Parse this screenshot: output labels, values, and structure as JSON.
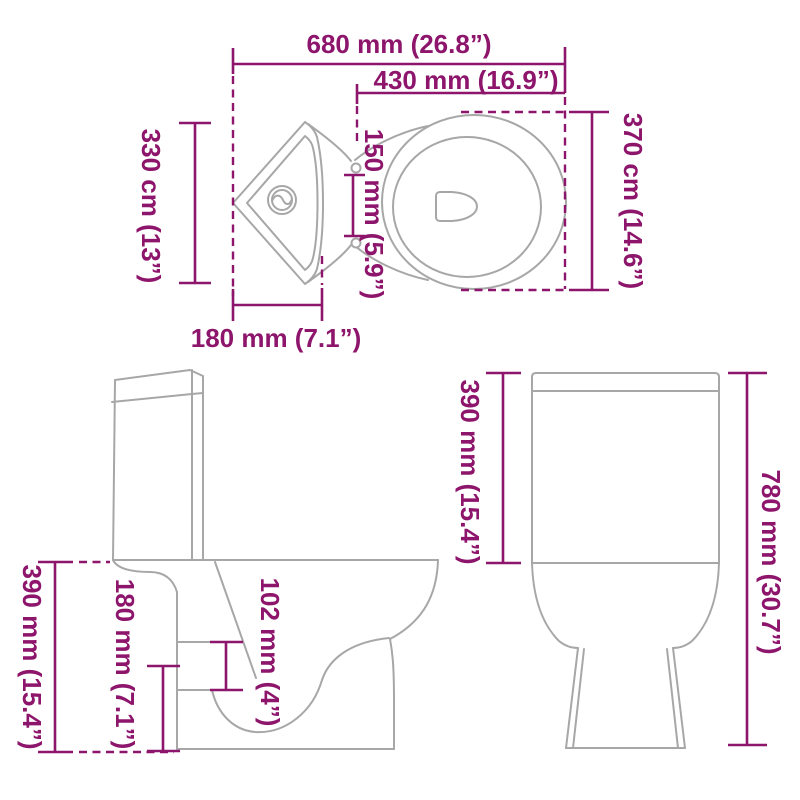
{
  "colors": {
    "accent": "#8D156B",
    "outline": "#A7A7A7",
    "background": "#FFFFFF"
  },
  "views": {
    "top": {
      "labels": {
        "overall_width": "680 mm (26.8”)",
        "seat_width": "430 mm (16.9”)",
        "cistern_depth": "330 cm (13”)",
        "hinge_distance": "150 mm (5.9”)",
        "bowl_length": "370 cm (14.6”)",
        "corner_width": "180 mm (7.1”)"
      }
    },
    "side": {
      "labels": {
        "seat_height": "390 mm (15.4”)",
        "outlet_center_height": "180 mm (7.1”)",
        "outlet_diameter": "102 mm (4”)"
      }
    },
    "front": {
      "labels": {
        "tank_height": "390 mm (15.4”)",
        "total_height": "780 mm (30.7”)"
      }
    }
  }
}
